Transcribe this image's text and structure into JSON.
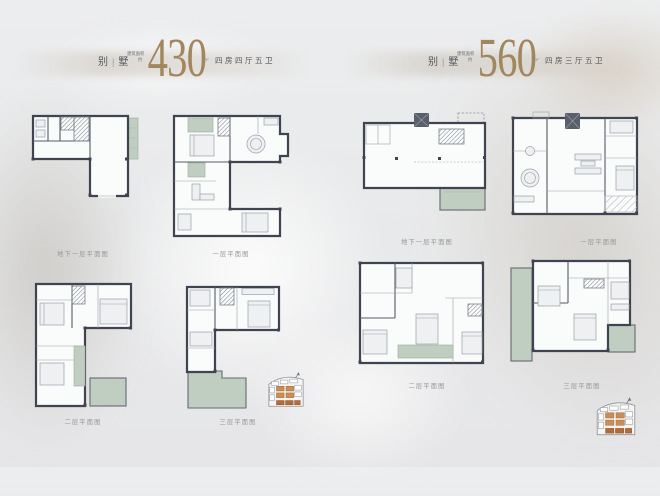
{
  "colors": {
    "background": "#e9eaec",
    "accent_bronze": "#a2875e",
    "wall": "#3f4450",
    "terrace_green": "#c0cec2",
    "caption_gray": "#96969a",
    "sitemap_orange": "#cb8d55"
  },
  "left": {
    "title": {
      "part1": "别",
      "divider": "|",
      "part2": "墅"
    },
    "area_label": {
      "line1": "建筑",
      "line2": "面积",
      "approx": "约"
    },
    "area_value": "430",
    "area_unit": "m²",
    "layout_text": "四房四厅五卫",
    "plans": [
      {
        "caption": "地下一层平面图"
      },
      {
        "caption": "一层平面图"
      },
      {
        "caption": "二层平面图"
      },
      {
        "caption": "三层平面图"
      }
    ]
  },
  "right": {
    "title": {
      "part1": "别",
      "divider": "|",
      "part2": "墅"
    },
    "area_label": {
      "line1": "建筑",
      "line2": "面积",
      "approx": "约"
    },
    "area_value": "560",
    "area_unit": "m²",
    "layout_text": "四房三厅五卫",
    "plans": [
      {
        "caption": "地下一层平面图"
      },
      {
        "caption": "一层平面图"
      },
      {
        "caption": "二层平面图"
      },
      {
        "caption": "三层平面图"
      }
    ]
  },
  "icons": {
    "north_arrow": "↑"
  }
}
